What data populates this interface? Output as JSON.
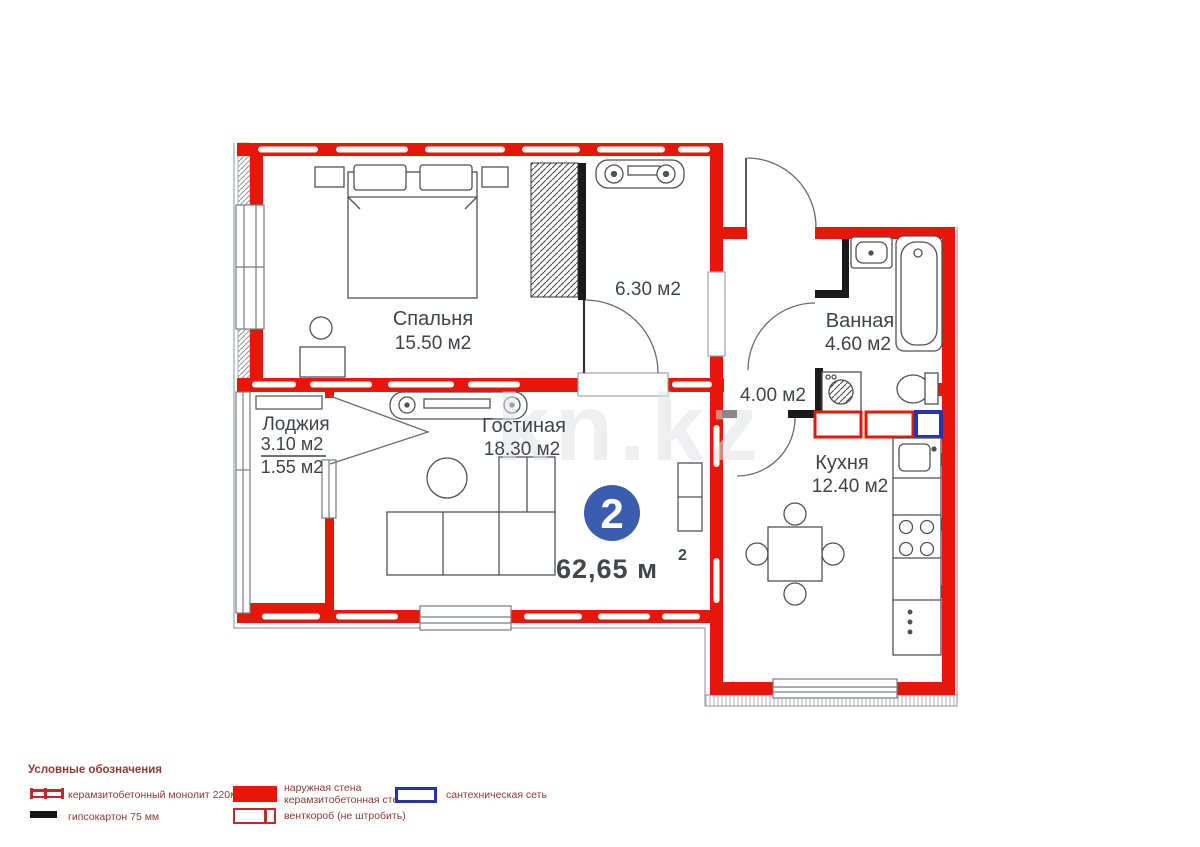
{
  "watermark": "kn.kz",
  "plan": {
    "badge_number": "2",
    "total_area": "62,65 м",
    "total_area_sup": "2",
    "rooms": {
      "bedroom": {
        "name": "Спальня",
        "area": "15.50 м2"
      },
      "hall": {
        "area": "6.30 м2"
      },
      "bathroom": {
        "name": "Ванная",
        "area": "4.60 м2"
      },
      "corridor": {
        "area": "4.00 м2"
      },
      "kitchen": {
        "name": "Кухня",
        "area": "12.40 м2"
      },
      "living": {
        "name": "Гостиная",
        "area": "18.30 м2"
      },
      "loggia": {
        "name": "Лоджия",
        "area_total": "3.10 м2",
        "area_counted": "1.55 м2"
      }
    }
  },
  "legend": {
    "title": "Условные обозначения",
    "items": {
      "monolith": "керамзитобетонный монолит 220мм",
      "drywall": "гипсокартон 75 мм",
      "exterior_line1": "наружная стена",
      "exterior_line2": "керамзитобетонная стена",
      "vent": "венткороб (не штробить)",
      "plumbing": "сантехническая сеть"
    }
  },
  "colors": {
    "wall_red": "#e61708",
    "wall_black": "#1a1a1a",
    "badge_blue": "#3a5dad",
    "plumbing_blue": "#2733ab",
    "legend_text": "#8e3a33",
    "label_text": "#3f444a"
  }
}
